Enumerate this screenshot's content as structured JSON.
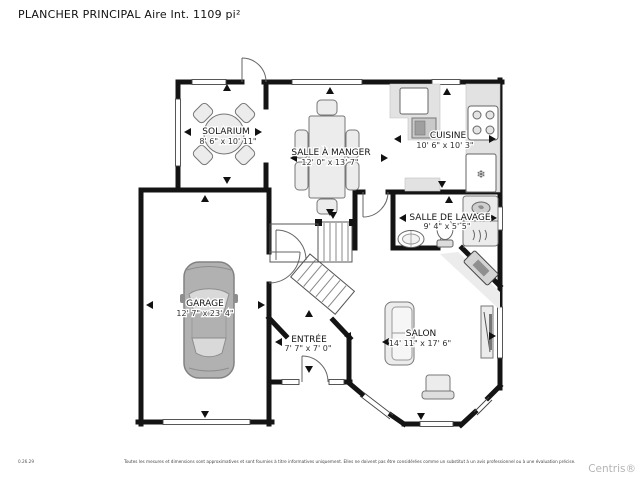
{
  "title": "PLANCHER PRINCIPAL Aire Int. 1109 pi²",
  "rooms": {
    "solarium": {
      "name": "SOLARIUM",
      "dims": "8' 6\" x 10' 11\""
    },
    "salle_a_manger": {
      "name": "SALLE À MANGER",
      "dims": "12' 0\" x 13' 7\""
    },
    "cuisine": {
      "name": "CUISINE",
      "dims": "10' 6\" x 10' 3\""
    },
    "salle_de_lavage": {
      "name": "SALLE DE LAVAGE",
      "dims": "9' 4\" x 5' 5\""
    },
    "garage": {
      "name": "GARAGE",
      "dims": "12' 7\" x 23' 4\""
    },
    "entree": {
      "name": "ENTRÉE",
      "dims": "7' 7\" x 7' 0\""
    },
    "salon": {
      "name": "SALON",
      "dims": "14' 11\" x 17' 6\""
    }
  },
  "footer": {
    "code": "0.26.29",
    "disclaimer": "Toutes les mesures et dimensions sont approximatives et sont fournies à titre informatives uniquement. Elles ne doivent pas être considérées comme un substitut à un avis professionnel ou à une évaluation précise.",
    "brand": "Centris®"
  },
  "colors": {
    "wall": "#141414",
    "furniture": "#ececec",
    "counter": "#e2e2e2",
    "car_body": "#b1b1b1",
    "brand_gray": "#b4b4b4"
  }
}
